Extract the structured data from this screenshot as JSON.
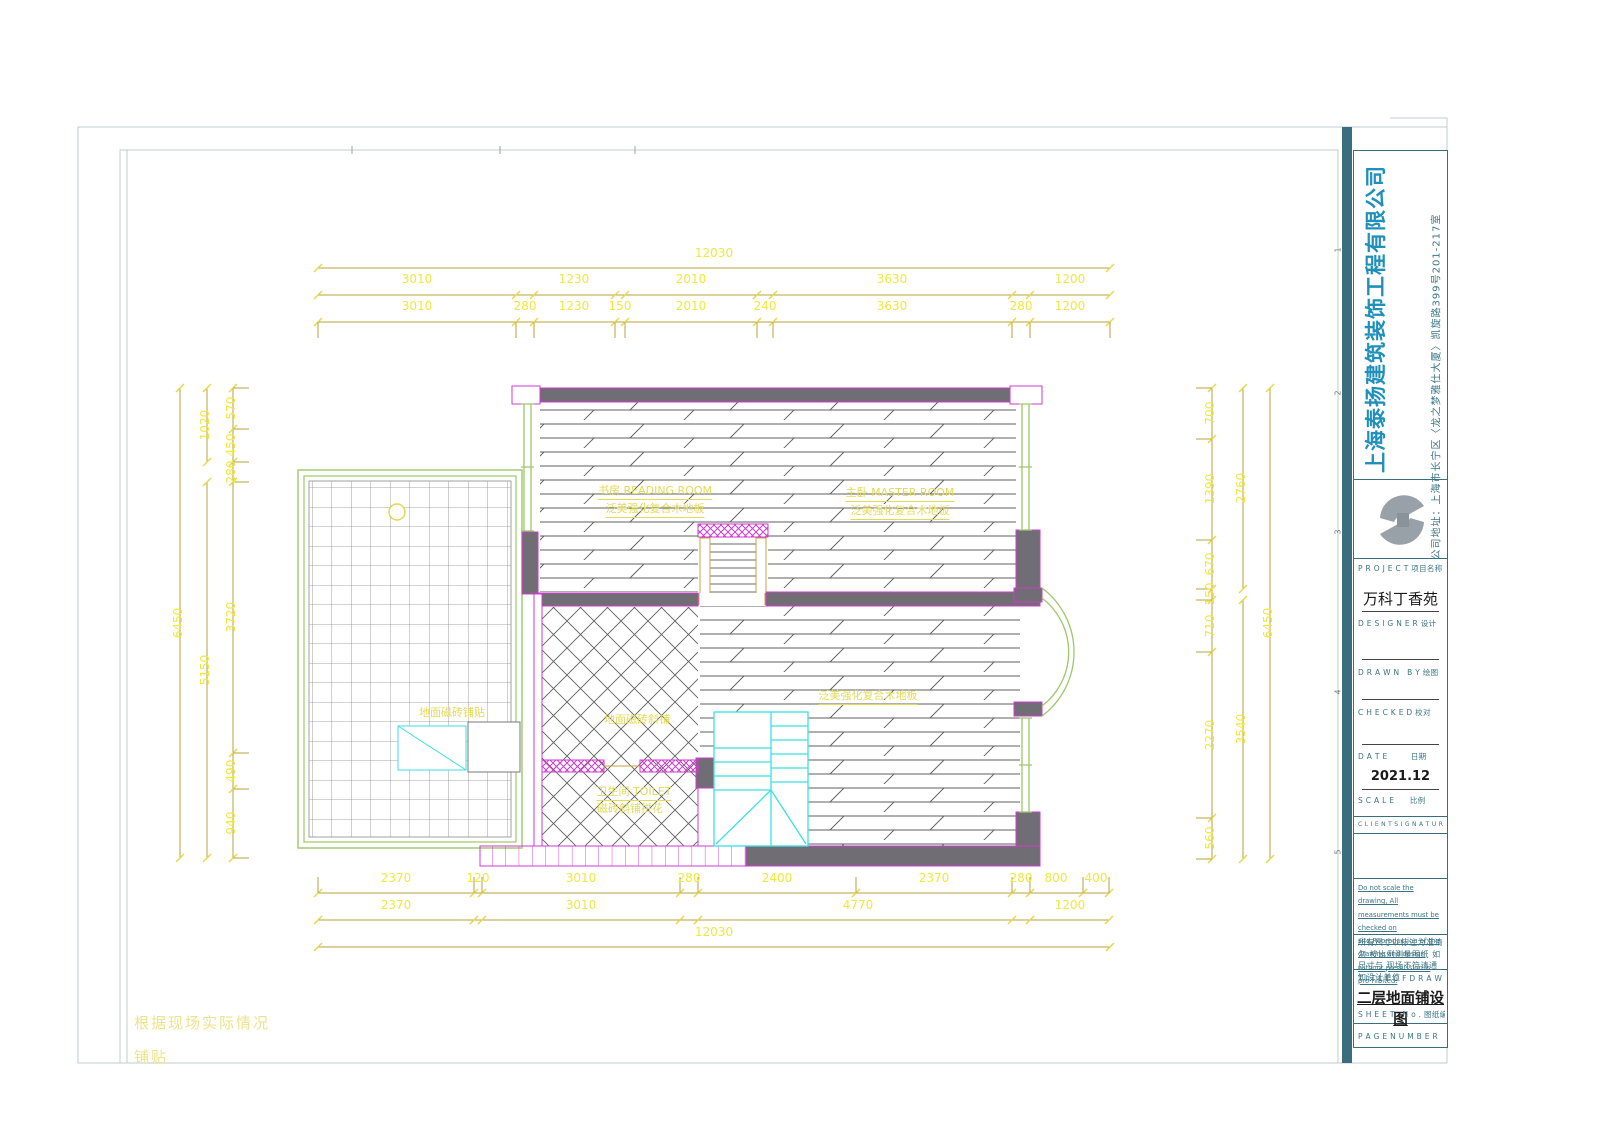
{
  "sheet": {
    "bottom_note_line1": "根据现场实际情况",
    "bottom_note_line2": "铺贴"
  },
  "title_block": {
    "company_name": "上海泰扬建筑装饰工程有限公司",
    "company_address": "公司地址：上海市长宁区〈龙之梦雅仕大厦〉凯旋路399号201-217室",
    "accent_color": "#2090bb",
    "frame_color": "#3a6e7e",
    "project_label": "P R O J E C T 项目名称",
    "project_name": "万科丁香苑",
    "designer_label": "D E S I G N E R 设计",
    "drawn_label": "D R A W N　B Y 绘图",
    "checked_label": "C H E C K E D 校对",
    "date_label": "D A T E　　　日期",
    "date_value": "2021.12",
    "scale_label": "S C A L E　　比例",
    "client_label": "C L I E N T S I G N A T U R E 客户签名",
    "note_en": "Do not scale the drawing, All measurements must be checked on site.Reproduction of the drawing and design without premission is pro-hibited.",
    "note_cn": "所有尺寸以标注为准请勿 按比例测量图纸 如尺寸与 现场不符请通知设计单位",
    "drawing_title_label": "T I T L E O F D R A W I N G 图纸名称",
    "drawing_title": "二层地面铺设图",
    "sheet_no_label": "S H E E T　N o . 图纸编号",
    "page_label": "P A G E N U M B E R　图纸页码",
    "fold_marks": [
      "1",
      "2",
      "3",
      "4",
      "5"
    ]
  },
  "plan_labels": [
    {
      "text": "书房 READING ROOM",
      "x": 655,
      "y": 491,
      "u": 1
    },
    {
      "text": "泛美强化复合木地板",
      "x": 655,
      "y": 509,
      "u": 1
    },
    {
      "text": "主卧 MASTER ROOM",
      "x": 900,
      "y": 493,
      "u": 1
    },
    {
      "text": "泛美强化复合木地板",
      "x": 900,
      "y": 511,
      "u": 1
    },
    {
      "text": "地面磁砖斜铺",
      "x": 637,
      "y": 719,
      "u": 0
    },
    {
      "text": "卫生间 TOILET",
      "x": 634,
      "y": 792,
      "u": 1
    },
    {
      "text": "磁砖斜铺拼花",
      "x": 630,
      "y": 808,
      "u": 0
    },
    {
      "text": "泛美强化复合木地板",
      "x": 868,
      "y": 696,
      "u": 1
    },
    {
      "text": "地面磁砖铺贴",
      "x": 452,
      "y": 712,
      "u": 0
    }
  ],
  "dimensions": {
    "text_color": "#f2e73c",
    "top": [
      {
        "text": "12030",
        "x": 714,
        "y": 253
      },
      {
        "text": "3010",
        "x": 417,
        "y": 279
      },
      {
        "text": "1230",
        "x": 574,
        "y": 279
      },
      {
        "text": "2010",
        "x": 691,
        "y": 279
      },
      {
        "text": "3630",
        "x": 892,
        "y": 279
      },
      {
        "text": "1200",
        "x": 1070,
        "y": 279
      },
      {
        "text": "3010",
        "x": 417,
        "y": 306
      },
      {
        "text": "280",
        "x": 525,
        "y": 306
      },
      {
        "text": "1230",
        "x": 574,
        "y": 306
      },
      {
        "text": "150",
        "x": 620,
        "y": 306
      },
      {
        "text": "2010",
        "x": 691,
        "y": 306
      },
      {
        "text": "240",
        "x": 765,
        "y": 306
      },
      {
        "text": "3630",
        "x": 892,
        "y": 306
      },
      {
        "text": "280",
        "x": 1021,
        "y": 306
      },
      {
        "text": "1200",
        "x": 1070,
        "y": 306
      }
    ],
    "bottom": [
      {
        "text": "2370",
        "x": 396,
        "y": 878
      },
      {
        "text": "120",
        "x": 478,
        "y": 878
      },
      {
        "text": "3010",
        "x": 581,
        "y": 878
      },
      {
        "text": "280",
        "x": 689,
        "y": 878
      },
      {
        "text": "2400",
        "x": 777,
        "y": 878
      },
      {
        "text": "2370",
        "x": 934,
        "y": 878
      },
      {
        "text": "280",
        "x": 1021,
        "y": 878
      },
      {
        "text": "800",
        "x": 1056,
        "y": 878
      },
      {
        "text": "400",
        "x": 1096,
        "y": 878
      },
      {
        "text": "2370",
        "x": 396,
        "y": 905
      },
      {
        "text": "3010",
        "x": 581,
        "y": 905
      },
      {
        "text": "4770",
        "x": 858,
        "y": 905
      },
      {
        "text": "1200",
        "x": 1070,
        "y": 905
      },
      {
        "text": "12030",
        "x": 714,
        "y": 932
      }
    ],
    "left": [
      {
        "text": "6450",
        "x": 178,
        "y": 623
      },
      {
        "text": "1020",
        "x": 205,
        "y": 425
      },
      {
        "text": "5150",
        "x": 205,
        "y": 670
      },
      {
        "text": "570",
        "x": 231,
        "y": 408
      },
      {
        "text": "450",
        "x": 231,
        "y": 445
      },
      {
        "text": "280",
        "x": 231,
        "y": 472
      },
      {
        "text": "3720",
        "x": 231,
        "y": 617
      },
      {
        "text": "490",
        "x": 231,
        "y": 771
      },
      {
        "text": "940",
        "x": 231,
        "y": 823
      }
    ],
    "right": [
      {
        "text": "700",
        "x": 1210,
        "y": 413
      },
      {
        "text": "1390",
        "x": 1210,
        "y": 489
      },
      {
        "text": "670",
        "x": 1210,
        "y": 564
      },
      {
        "text": "150",
        "x": 1210,
        "y": 594
      },
      {
        "text": "710",
        "x": 1210,
        "y": 626
      },
      {
        "text": "2270",
        "x": 1210,
        "y": 735
      },
      {
        "text": "560",
        "x": 1210,
        "y": 838
      },
      {
        "text": "2760",
        "x": 1241,
        "y": 488
      },
      {
        "text": "3540",
        "x": 1241,
        "y": 729
      },
      {
        "text": "6450",
        "x": 1268,
        "y": 623
      }
    ]
  }
}
